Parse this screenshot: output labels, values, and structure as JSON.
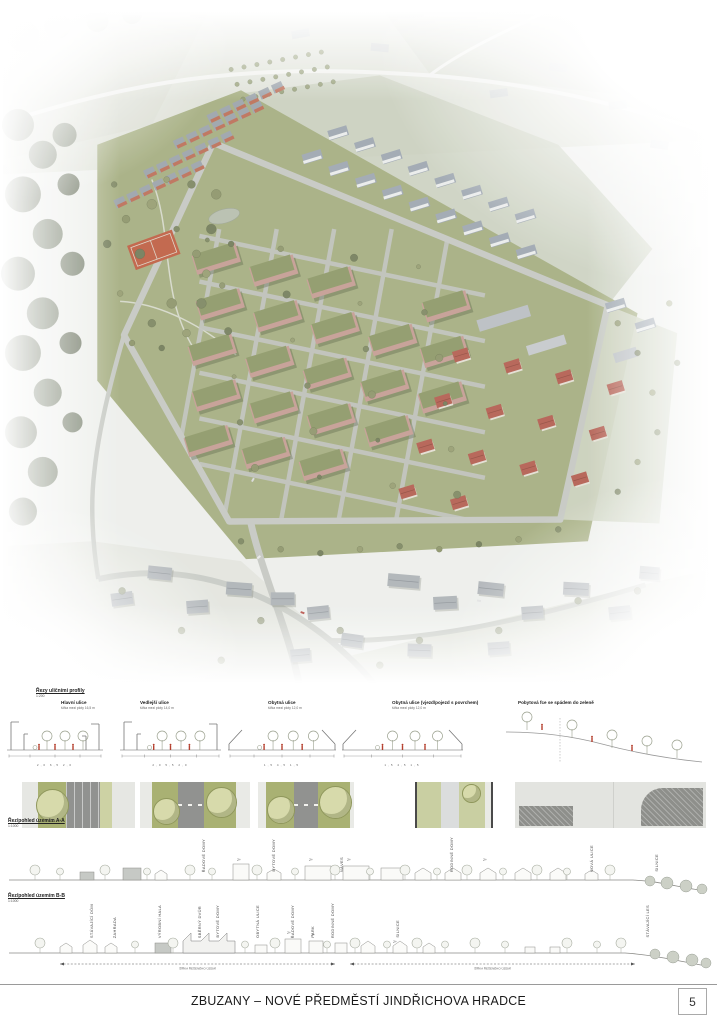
{
  "board": {
    "title": "ZBUZANY – NOVÉ PŘEDMĚSTÍ JINDŘICHOVA HRADCE",
    "page_number": "5"
  },
  "street_profiles": {
    "heading": "Řezy uličními profily",
    "scale": "1:200",
    "sections": [
      {
        "title": "Hlavní ulice",
        "subtitle": "šířka mezi ploty 16,5 m",
        "dims": "2,0  6,5  2,0"
      },
      {
        "title": "Vedlejší ulice",
        "subtitle": "šířka mezi ploty 14,0 m",
        "dims": "2,0  5,5  2,0"
      },
      {
        "title": "Obytná ulice",
        "subtitle": "šířka mezi ploty 12,0 m",
        "dims": "1,5  4,5  1,5"
      },
      {
        "title": "Obytná ulice (vjezd/pojezd s povrchem)",
        "subtitle": "šířka mezi ploty 12,0 m",
        "dims": "1,5  4,5  1,5"
      },
      {
        "title": "Pobytová fce se spádem do zeleně",
        "subtitle": "",
        "dims": ""
      }
    ]
  },
  "section_aa": {
    "heading": "Řez/pohled územím A-A",
    "scale": "1:1000",
    "labels": [
      "ŘADOVÉ DOMY",
      "BYTOVÉ DOMY",
      "NÁVES",
      "RODINNÉ DOMY",
      "NOVÁ ULICE",
      "SILNICE"
    ]
  },
  "section_bb": {
    "heading": "Řez/pohled územím B-B",
    "scale": "1:1000",
    "labels": [
      "STÁVAJÍCÍ DŮM",
      "ZAHRADA",
      "VÝROBNÍ HALA",
      "SBĚRNÝ DVŮR",
      "BYTOVÉ DOMY",
      "OBYTNÁ ULICE",
      "ŘADOVÉ DOMY",
      "PARK",
      "RODINNÉ DOMY",
      "SILNICE",
      "STÁVAJÍCÍ LES"
    ],
    "dim_left": "ŠÍŘKA ŘEŠENÉHO ÚZEMÍ",
    "dim_right": "ŠÍŘKA ŘEŠENÉHO ÚZEMÍ"
  },
  "floor_mark": "2+"
}
